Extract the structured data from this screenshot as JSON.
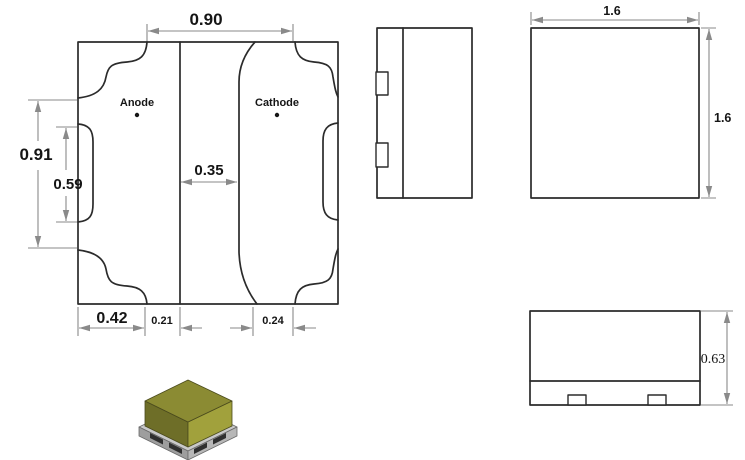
{
  "drawing": {
    "footprint": {
      "anode_label": "Anode",
      "cathode_label": "Cathode",
      "dim_pad_span_top": "0.90",
      "dim_height_outer": "0.91",
      "dim_notch_height": "0.59",
      "dim_center_gap": "0.35",
      "dim_pad_width": "0.42",
      "dim_inset_left": "0.21",
      "dim_inset_right": "0.24"
    },
    "top_view": {
      "dim_width": "1.6",
      "dim_height": "1.6"
    },
    "front_view": {
      "dim_height": "0.63"
    },
    "colors": {
      "outline": "#2b2b2b",
      "dimension": "#8a8a8a",
      "body_top": "#8b8b33",
      "body_left": "#6e6e28",
      "body_right": "#a1a13c",
      "base_top": "#c9c9c9",
      "base_front_left": "#9e9e9e",
      "base_front_right": "#b7b7b7",
      "pad_dark": "#2f2f2f"
    }
  }
}
